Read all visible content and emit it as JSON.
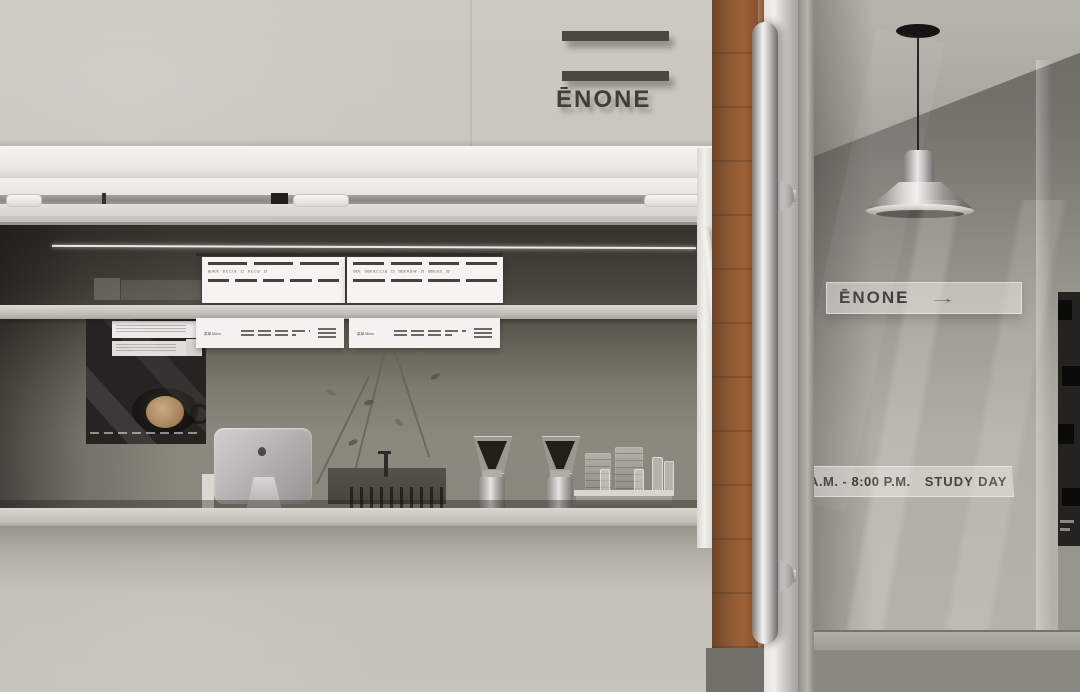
{
  "logo": {
    "text": "ĒNONE",
    "bar_count": 2
  },
  "wayfinding_sign": {
    "text": "ĒNONE",
    "arrow": "→"
  },
  "hours_sign": {
    "time": "A.M. - 8:00 P.M.",
    "label": "STUDY DAY"
  },
  "menu_board_left": {
    "cells": [
      "BLACK",
      "B.C C.I.B",
      "12",
      "A.C.C.B",
      "13"
    ]
  },
  "menu_board_right": {
    "cells": [
      "SIDE",
      "SIDE B.C C.I.B",
      "15",
      "SIDE R.B W",
      "15",
      "SIDE B.D",
      "26"
    ]
  },
  "menu_strip": {
    "cn": "菜单",
    "en": "Menu"
  },
  "palette": {
    "facade": "#c9c6bf",
    "window_frame": "#f3f2ef",
    "interior_dark": "#36332d",
    "interior_wall": "#8a887d",
    "wood_door": "#8a5733",
    "steel": "#d0cfcc",
    "right_wall": "#b0ada5",
    "sign_text": "#3b3a36",
    "menu_bar": "#45433e",
    "latte": "#a9855e"
  }
}
